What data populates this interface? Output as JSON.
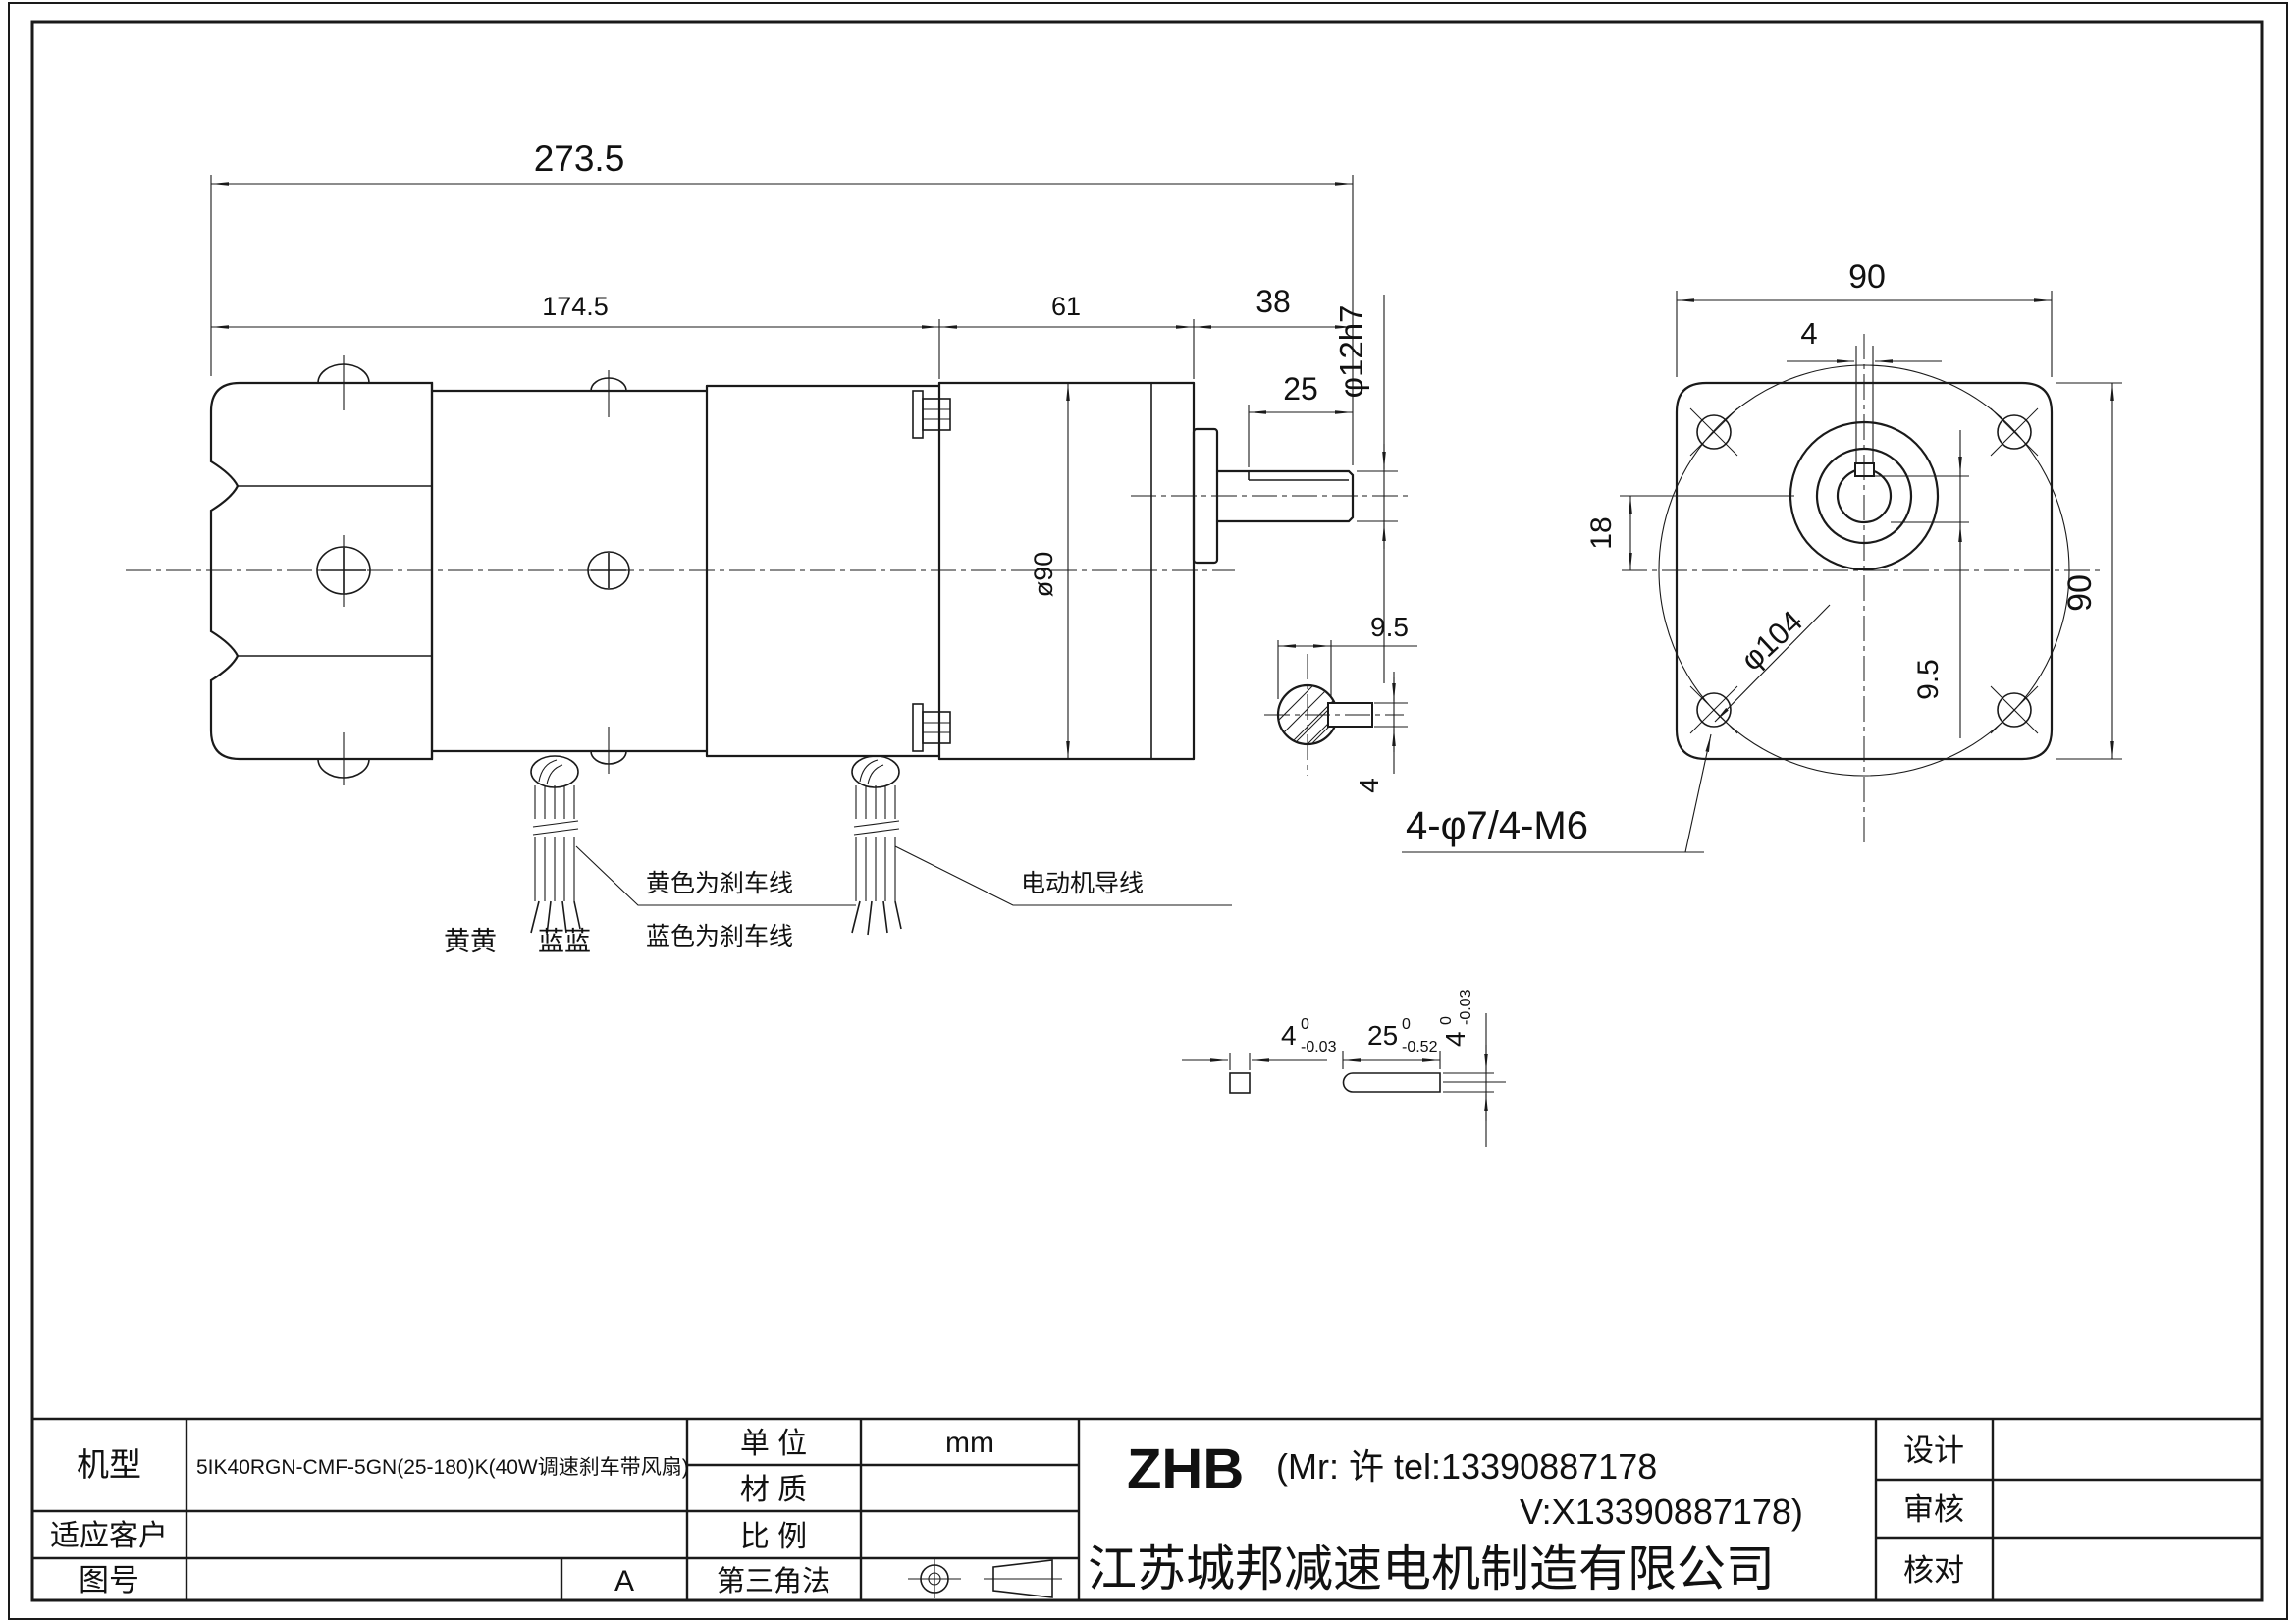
{
  "side_view": {
    "dim_total": "273.5",
    "dim_motor": "174.5",
    "dim_gearbox": "61",
    "dim_shaft": "38",
    "dim_keyway": "25",
    "dim_shaft_dia": "φ12h7",
    "dim_body_dia": "ø90",
    "label_yellow_brake": "黄色为刹车线",
    "label_blue_brake": "蓝色为刹车线",
    "label_motor_lead": "电动机导线",
    "label_yellow_pair": "黄黄",
    "label_blue_pair": "蓝蓝"
  },
  "end_view": {
    "dim_width": "90",
    "dim_height": "90",
    "dim_key_width": "4",
    "dim_offset": "18",
    "dim_bolt_circle": "φ104",
    "dim_key_depth": "9.5",
    "label_mount_holes": "4-φ7/4-M6"
  },
  "shaft_section": {
    "dim_width": "9.5",
    "dim_height": "4"
  },
  "key_detail": {
    "dim_w": "4",
    "dim_w_tol_hi": "0",
    "dim_w_tol_lo": "-0.03",
    "dim_len": "25",
    "dim_len_tol_hi": "0",
    "dim_len_tol_lo": "-0.52",
    "dim_h": "4",
    "dim_h_tol_hi": "0",
    "dim_h_tol_lo": "-0.03"
  },
  "title_block": {
    "model_label": "机型",
    "model_value": "5IK40RGN-CMF-5GN(25-180)K(40W调速刹车带风扇)",
    "customer_label": "适应客户",
    "drawing_no_label": "图号",
    "revision": "A",
    "unit_label": "单  位",
    "unit_value": "mm",
    "material_label": "材  质",
    "scale_label": "比  例",
    "projection_label": "第三角法",
    "brand": "ZHB",
    "contact_line1": "(Mr: 许 tel:13390887178",
    "contact_line2": "V:X13390887178)",
    "company": "江苏城邦减速电机制造有限公司",
    "designer_label": "设计",
    "reviewer_label": "审核",
    "checker_label": "核对"
  }
}
